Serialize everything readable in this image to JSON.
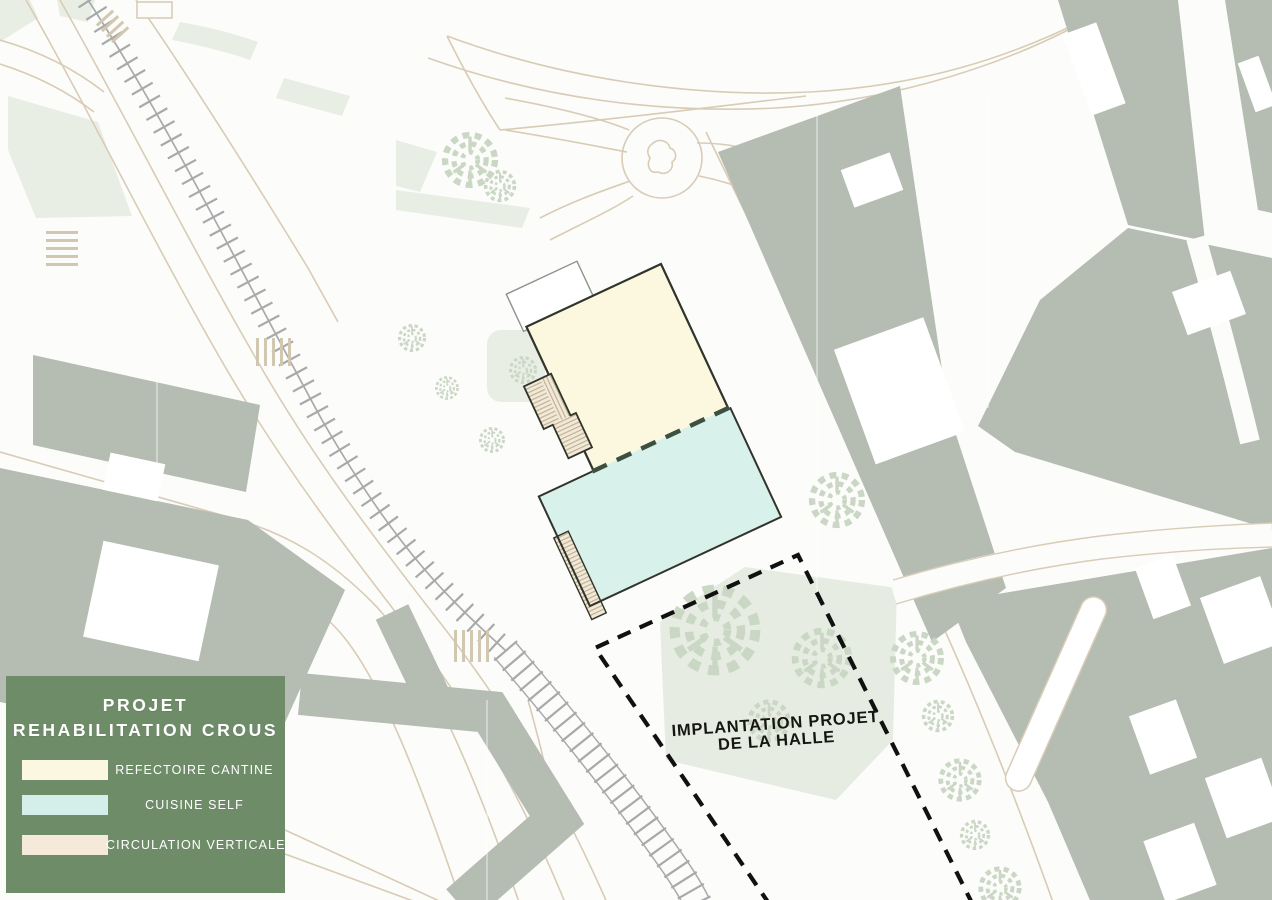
{
  "legend": {
    "bg_style": "background-color:#6F8C69",
    "background_color": "#6F8C69",
    "title_line1": "PROJET",
    "title_line2": "REHABILITATION CROUS",
    "items": [
      {
        "label": "REFECTOIRE CANTINE",
        "color": "#FBF7E0",
        "swatch_style": "background-color:#FBF7E0"
      },
      {
        "label": "CUISINE SELF",
        "color": "#D4EEE9",
        "swatch_style": "background-color:#D4EEE9"
      },
      {
        "label": "CIRCULATION VERTICALE",
        "color": "#F5EAD9",
        "swatch_style": "background-color:#F5EAD9"
      }
    ]
  },
  "annotations": {
    "halle_label_line1": "IMPLANTATION PROJET",
    "halle_label_line2": "DE LA HALLE"
  },
  "map_colors": {
    "building_gray": "#B5BCB2",
    "park_green": "#E9EEE5",
    "road_line": "#D8CCB6",
    "railway_gray": "#A7A9AB",
    "refectoire_fill": "#FBF8DF",
    "cuisine_fill": "#D8F1EA",
    "circulation_fill": "#F2E9D7",
    "outline_dark": "#31342B",
    "divider_dash": "#3C4F41",
    "halle_dash": "#111111",
    "tree_green": "#CBD7C5"
  }
}
